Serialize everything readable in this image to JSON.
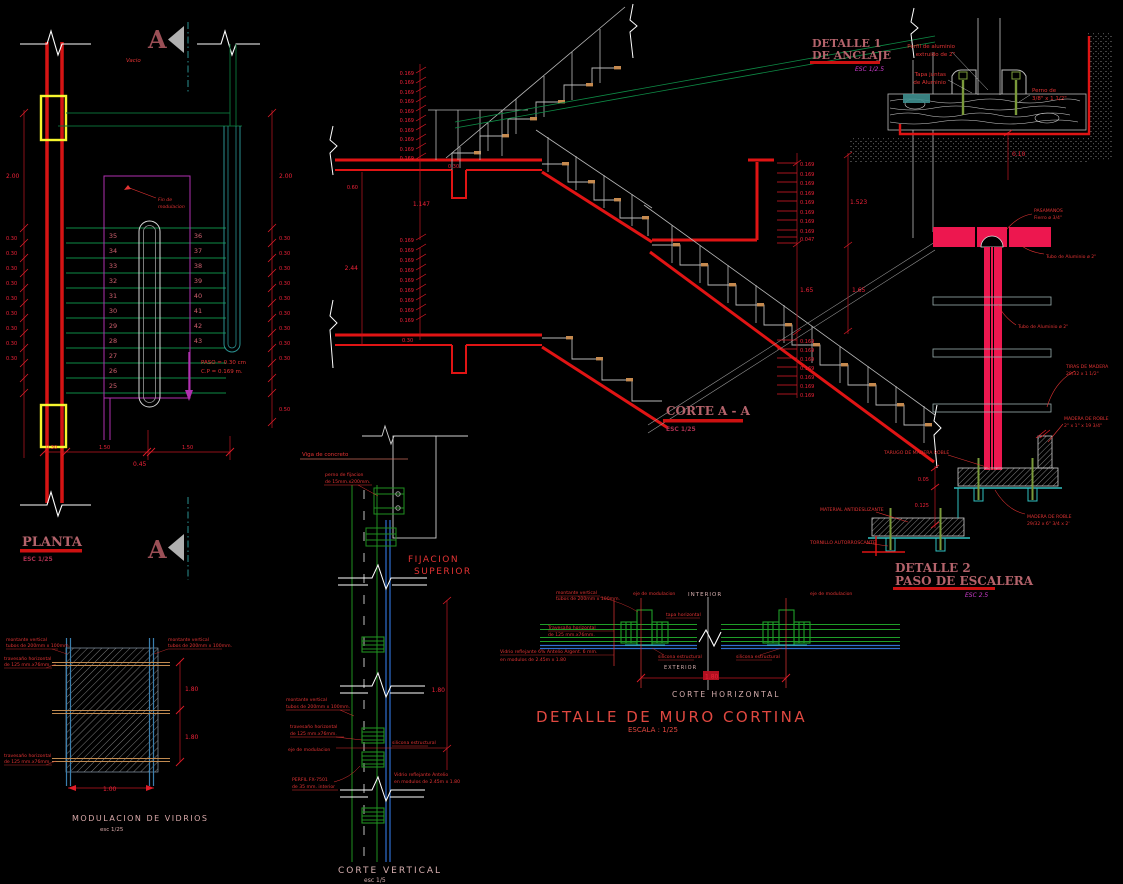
{
  "drawing": {
    "planta": {
      "title": "PLANTA",
      "scale": "ESC 1/25",
      "marker_top": "A",
      "marker_bottom": "A",
      "void_label": "Vacio",
      "opening_l1": "Fin de",
      "opening_l2": "modulacion",
      "paso_l1": "PASO = 0.30 cm",
      "paso_l2": "C.P = 0.169 m.",
      "steps_left": [
        "35",
        "34",
        "33",
        "32",
        "31",
        "30",
        "29",
        "28",
        "27",
        "26",
        "25"
      ],
      "steps_right": [
        "36",
        "37",
        "38",
        "39",
        "40",
        "41",
        "42",
        "43"
      ],
      "dim_height_left": "2.00",
      "dim_height_right": "2.00",
      "tread_dims_left": [
        "0.30",
        "0.30",
        "0.30",
        "0.30",
        "0.30",
        "0.30",
        "0.30",
        "0.30",
        "0.30"
      ],
      "tread_dims_right": [
        "0.30",
        "0.30",
        "0.30",
        "0.30",
        "0.30",
        "0.30",
        "0.30",
        "0.30",
        "0.30"
      ],
      "dim_right_bottom": "0.50",
      "bottom_dims": [
        "0.30",
        "1.50",
        "1.50"
      ],
      "bottom_total": "0.45"
    },
    "corte": {
      "title": "CORTE A - A",
      "scale": "ESC 1/25",
      "risers_upper": [
        "0.169",
        "0.169",
        "0.169",
        "0.169",
        "0.169",
        "0.169",
        "0.169",
        "0.169",
        "0.169",
        "0.169"
      ],
      "slab": "0.30",
      "beam_depth": "0.60",
      "beam_dim": "1.147",
      "total_left": "2.44",
      "risers_lower": [
        "0.169",
        "0.169",
        "0.169",
        "0.169",
        "0.169",
        "0.169",
        "0.169",
        "0.169",
        "0.169"
      ],
      "slab_lower": "0.30",
      "right_risers_a": [
        "0.169",
        "0.169",
        "0.169",
        "0.169",
        "0.169",
        "0.169",
        "0.169",
        "0.169"
      ],
      "right_small": "0.047",
      "right_mid_l": "1.65",
      "right_mid_r": "1.65",
      "right_top": "1.523",
      "right_risers_b": [
        "0.169",
        "0.169",
        "0.169",
        "0.169",
        "0.169",
        "0.169",
        "0.169"
      ]
    },
    "detalle1": {
      "title_l1": "DETALLE 1",
      "title_l2": "DE ANCLAJE",
      "scale": "ESC 1/2.5",
      "perfil_l1": "Perfil de aluminio",
      "perfil_l2": "extruido de 2\"",
      "tapa_l1": "Tapa juntas",
      "tapa_l2": "de Aluminio",
      "perno_l1": "Perno de",
      "perno_l2": "3/8\" x 1 1/2\"",
      "dim": "0.10"
    },
    "pasamano": {
      "label1_l1": "PASAMANOS",
      "label1_l2": "Fierro ø 3/4\"",
      "label2": "Tubo de Aluminio ø 2\"",
      "label3": "Tubo de Aluminio ø 2\"",
      "label4_l1": "TIRAS DE MADERA",
      "label4_l2": "29/32 x 1 1/2\""
    },
    "detalle2": {
      "title_l1": "DETALLE 2",
      "title_l2": "PASO DE ESCALERA",
      "scale": "ESC 2.5",
      "tarugo": "TARUGO DE MADERA ROBLE",
      "madera1_l1": "MADERA DE ROBLE",
      "madera1_l2": "2\" x 1\" x 19 3/4\"",
      "madera2_l1": "MADERA DE ROBLE",
      "madera2_l2": "29/32 x 6\" 3/4 x 2'",
      "antideslizante": "MATERIAL ANTIDESLIZANTE",
      "tornillo": "TORNILLO AUTORROSCANTE",
      "dim_a": "0.05",
      "dim_b": "0.125"
    },
    "corte_vertical": {
      "title": "CORTE VERTICAL",
      "scale": "esc 1/5",
      "viga": "Viga de concreto",
      "perno_l1": "perno de fijacion",
      "perno_l2": "de 15mm.x200mm.",
      "fijacion_l1": "FIJACION",
      "fijacion_l2": "SUPERIOR",
      "montante_l1": "montante vertical",
      "montante_l2": "tubos de 200mm x 100mm.",
      "travesano_l1": "travesaño  horizontal",
      "travesano_l2": "de 125 mm.x76mm.",
      "eje": "eje de modulacion",
      "silicona": "silicona  estructural",
      "perfil_l1": "PERFIL  FX-7501",
      "perfil_l2": "de 35 mm. interior",
      "vidrio_l1": "Vidrio reflejante Antelio",
      "vidrio_l2": "en modulos de 2.45m x 1.80",
      "dim": "1.80"
    },
    "modulacion": {
      "title": "MODULACION  DE  VIDRIOS",
      "scale": "esc 1/25",
      "montante_l1": "montante vertical",
      "montante_l2": "tubos de 200mm x 100mm.",
      "montante2_l1": "montante vertical",
      "montante2_l2": "tubos de 200mm x 100mm.",
      "travesano_l1": "travesaño  horizontal",
      "travesano_l2": "de 125 mm.x76mm.",
      "travesano2_l1": "travesaño  horizontal",
      "travesano2_l2": "de 125 mm.x76mm.",
      "dims_right": [
        "1.80",
        "1.80"
      ],
      "dim_bottom": "1.00"
    },
    "muro_cortina": {
      "title": "DETALLE  DE  MURO  CORTINA",
      "scale": "ESCALA : 1/25",
      "corte_h": "CORTE  HORIZONTAL",
      "interior": "INTERIOR",
      "exterior": "EXTERIOR",
      "montante_l1": "montante vertical",
      "montante_l2": "tubos de 200mm x 100mm.",
      "eje_left": "eje de modulacion",
      "eje_right": "eje de modulacion",
      "tapa": "tapa horizontal",
      "travesano_l1": "Travesaño  horizontal",
      "travesano_l2": "de 125 mm.x76mm.",
      "vidrio_l1": "Vidrio reflejante 6% Antelio Argent. 6 mm.",
      "vidrio_l2": "en modulos de 2.45m x 1.80",
      "silicona_left": "silicona  estructural",
      "silicona_right": "silicona  estructural",
      "dim": "1.80"
    }
  }
}
